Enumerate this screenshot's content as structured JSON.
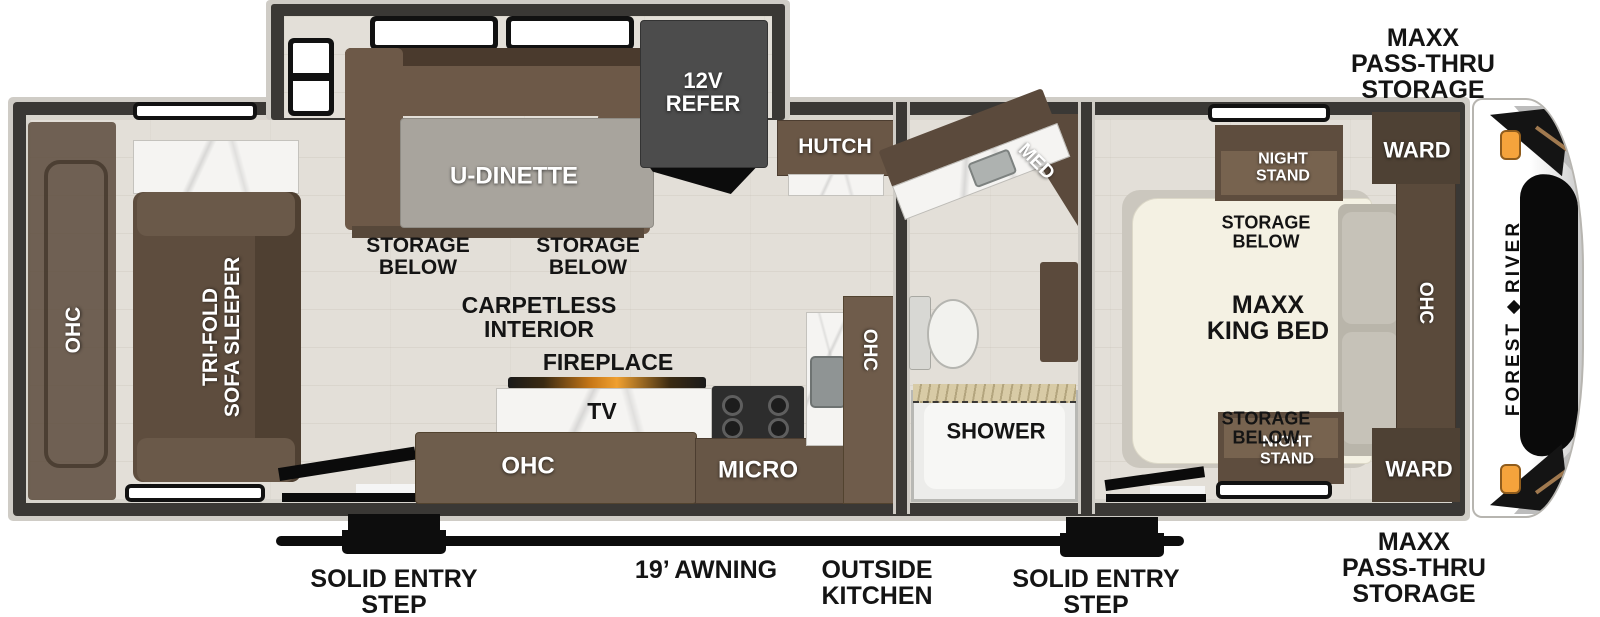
{
  "exterior": {
    "brand_first": "FOREST",
    "brand_second": "RIVER",
    "storage_label_top": "MAXX\nPASS-THRU\nSTORAGE",
    "storage_label_bottom": "MAXX\nPASS-THRU\nSTORAGE",
    "awning_label": "19’ AWNING",
    "outside_kitchen_label": "OUTSIDE\nKITCHEN",
    "entry_step_label_left": "SOLID ENTRY\nSTEP",
    "entry_step_label_right": "SOLID ENTRY\nSTEP"
  },
  "living_area": {
    "rear_ohc": "OHC",
    "sofa": "TRI-FOLD\nSOFA SLEEPER",
    "dinette": "U-DINETTE",
    "dinette_storage_left": "STORAGE\nBELOW",
    "dinette_storage_right": "STORAGE\nBELOW",
    "refrigerator": "12V\nREFER",
    "hutch": "HUTCH",
    "flooring_note": "CARPETLESS\nINTERIOR",
    "fireplace": "FIREPLACE",
    "tv": "TV",
    "entertainment_ohc": "OHC",
    "microwave": "MICRO",
    "kitchen_ohc": "OHC"
  },
  "bathroom": {
    "medicine_cabinet": "MED",
    "shower": "SHOWER"
  },
  "bedroom": {
    "night_stand_top": "NIGHT\nSTAND",
    "night_stand_bottom": "NIGHT\nSTAND",
    "wardrobe_top": "WARD",
    "wardrobe_bottom": "WARD",
    "bed_storage_top": "STORAGE\nBELOW",
    "bed_storage_bottom": "STORAGE\nBELOW",
    "bed": "MAXX\nKING BED",
    "bed_ohc": "OHC"
  },
  "colors": {
    "wall": "#3a3835",
    "trim": "#cfccc6",
    "floor": "#e3dfd8",
    "cabinet_brown": "#6e5c4b",
    "cabinet_dark": "#4e4134",
    "sofa_brown": "#5e4d3e",
    "refer_gray": "#4c4c4c",
    "table_gray": "#a8a49d",
    "bed_cream": "#f4f1e3",
    "accent_orange": "#f5a33c",
    "label_black": "#141414"
  }
}
